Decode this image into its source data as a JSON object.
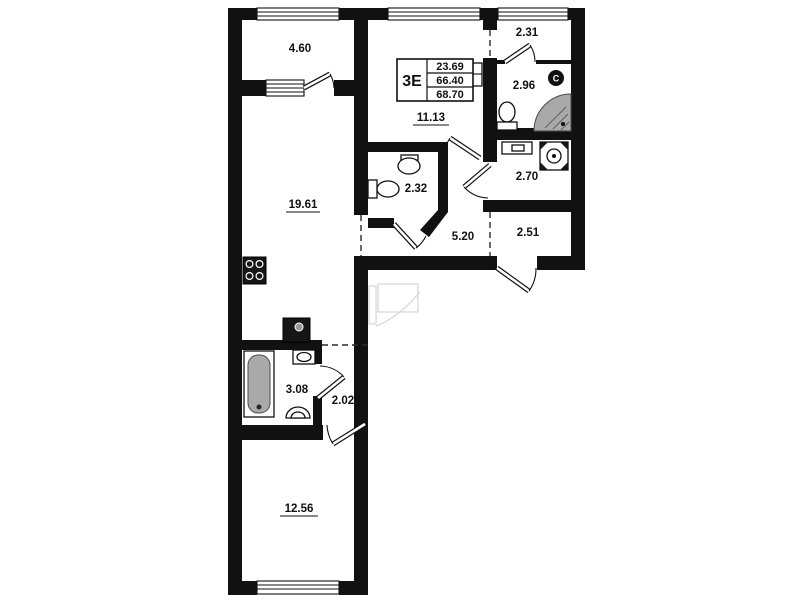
{
  "stamp": {
    "type_label": "3Е",
    "living_area": "23.69",
    "apartment_area": "66.40",
    "total_area": "68.70"
  },
  "rooms": {
    "balcony": {
      "area": "4.60"
    },
    "kitchen_living": {
      "area": "19.61"
    },
    "room_top": {
      "area": "11.13"
    },
    "hall_top": {
      "area": "2.31"
    },
    "bathroom_top": {
      "area": "2.96"
    },
    "wc": {
      "area": "2.32"
    },
    "storage": {
      "area": "2.70"
    },
    "corridor": {
      "area": "5.20"
    },
    "entry_hall": {
      "area": "2.51"
    },
    "bathroom": {
      "area": "3.08"
    },
    "hall": {
      "area": "2.02"
    },
    "bedroom": {
      "area": "12.56"
    }
  },
  "fixtures": {
    "vent_label": "C"
  },
  "colors": {
    "wall": "#111111",
    "fixture_gray": "#a9a9a9",
    "ghost": "#d6d6d6"
  }
}
